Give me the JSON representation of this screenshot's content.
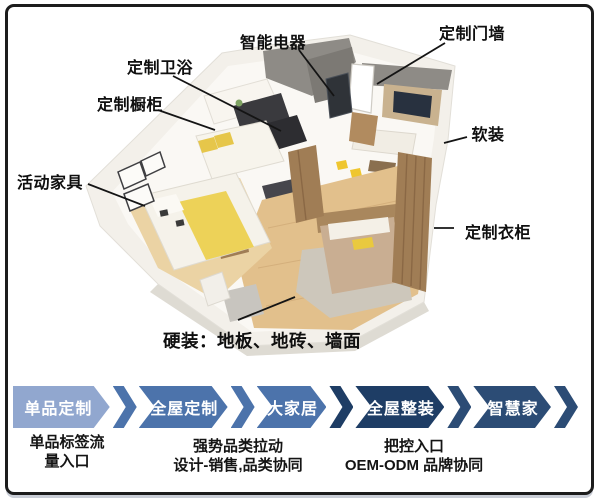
{
  "slide": {
    "floorplan_labels": [
      {
        "id": "smart-appliances",
        "text": "智能电器"
      },
      {
        "id": "custom-door-wall",
        "text": "定制门墙"
      },
      {
        "id": "custom-bathroom",
        "text": "定制卫浴"
      },
      {
        "id": "custom-cabinets",
        "text": "定制橱柜"
      },
      {
        "id": "movable-furniture",
        "text": "活动家具"
      },
      {
        "id": "soft-furnishing",
        "text": "软装"
      },
      {
        "id": "custom-wardrobe",
        "text": "定制衣柜"
      },
      {
        "id": "hard-furnishing",
        "text": "硬装：地板、地砖、墙面"
      }
    ],
    "process": {
      "stages": [
        {
          "label": "单品定制",
          "color": "#91A7CF",
          "band_color": "#4C73AB"
        },
        {
          "label": "全屋定制",
          "color": "#4C73AB",
          "band_color": "#4C73AB"
        },
        {
          "label": "大家居",
          "color": "#4C73AB",
          "band_color": "#1E3D65"
        },
        {
          "label": "全屋整装",
          "color": "#1E3D65",
          "band_color": "#2C4C75"
        },
        {
          "label": "智慧家",
          "color": "#2C4C75",
          "band_color": "#2C4C75"
        }
      ],
      "notes": [
        {
          "line1": "单品标签流",
          "line2": "量入口"
        },
        {
          "line1": "强势品类拉动",
          "line2": "设计-销售,品类协同"
        },
        {
          "line1": "把控入口",
          "line2": "OEM-ODM 品牌协同"
        }
      ]
    }
  }
}
